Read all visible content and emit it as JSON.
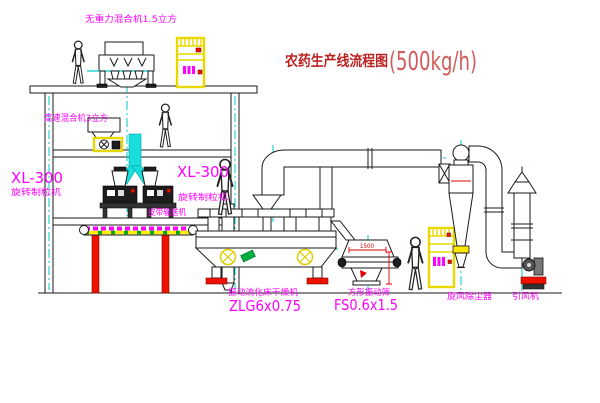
{
  "title": {
    "text": "农药生产线流程图",
    "capacity": "(500kg/h)"
  },
  "equipment_labels": {
    "gravity_mixer": "无重力混合机1.5立方",
    "high_speed_mixer": "高速混合机3立方",
    "granulator_left_model": "XL-300",
    "granulator_left_name": "旋转制粒机",
    "granulator_center_model": "XL-300",
    "granulator_center_name": "旋转制粒机",
    "belt_conveyor": "皮带输送机",
    "fluid_bed_dryer_name": "振动流化床干燥机",
    "fluid_bed_dryer_model": "ZLG6x0.75",
    "square_sieve_name": "方形振动筛",
    "square_sieve_model": "FS0.6x1.5",
    "cyclone_collector": "旋风除尘器",
    "induced_draft_fan": "引风机"
  },
  "dimensions": {
    "sieve_width": "1500"
  },
  "colors": {
    "background": "#ffffff",
    "line_black": "#1a1a1a",
    "label_magenta": "#ff00ff",
    "title_red": "#bb2222",
    "capacity_red": "#d05b5b",
    "centerline_cyan": "#00c8c8",
    "duct_cyan_fill": "#19dede",
    "cabinet_yellow": "#e8d800",
    "accent_red": "#ee1100",
    "accent_green": "#00b140"
  }
}
